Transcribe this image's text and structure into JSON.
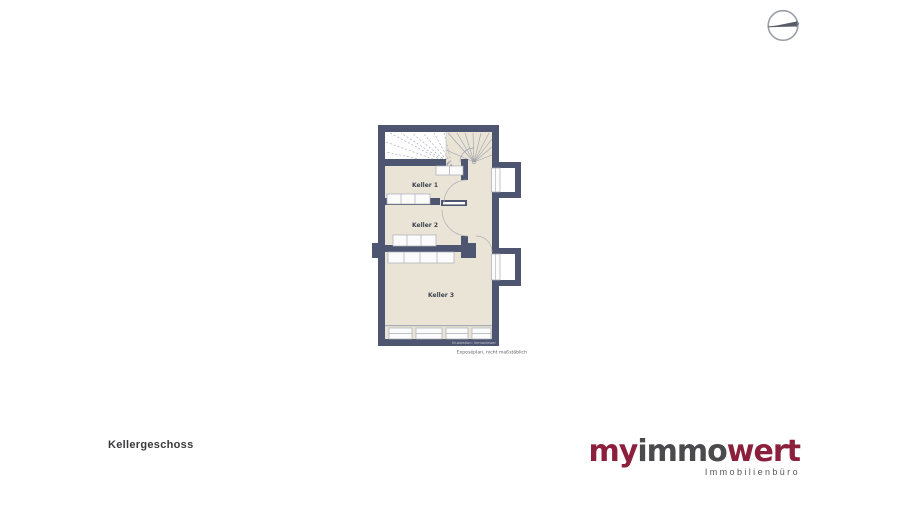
{
  "page": {
    "background_color": "#ffffff"
  },
  "compass": {
    "icon_name": "compass-needle-icon"
  },
  "floorplan": {
    "title_label": "Kellergeschoss",
    "rooms": [
      {
        "label": "Keller 1"
      },
      {
        "label": "Keller 2"
      },
      {
        "label": "Keller 3"
      }
    ],
    "watermark": "Illustration: immoviewer",
    "disclaimer": "Exposéplan, nicht maßstäblich",
    "colors": {
      "wall": "#4e5570",
      "floor": "#eae4d6",
      "window_frame": "#a8adb5",
      "stair_line": "#9ba0ab"
    }
  },
  "branding": {
    "logo_part_my": "my",
    "logo_part_immo": "immo",
    "logo_part_wert": "wert",
    "logo_subtitle": "Immobilienbüro",
    "logo_color_accent": "#8c1f3c",
    "logo_color_gray": "#4b4b4d"
  }
}
